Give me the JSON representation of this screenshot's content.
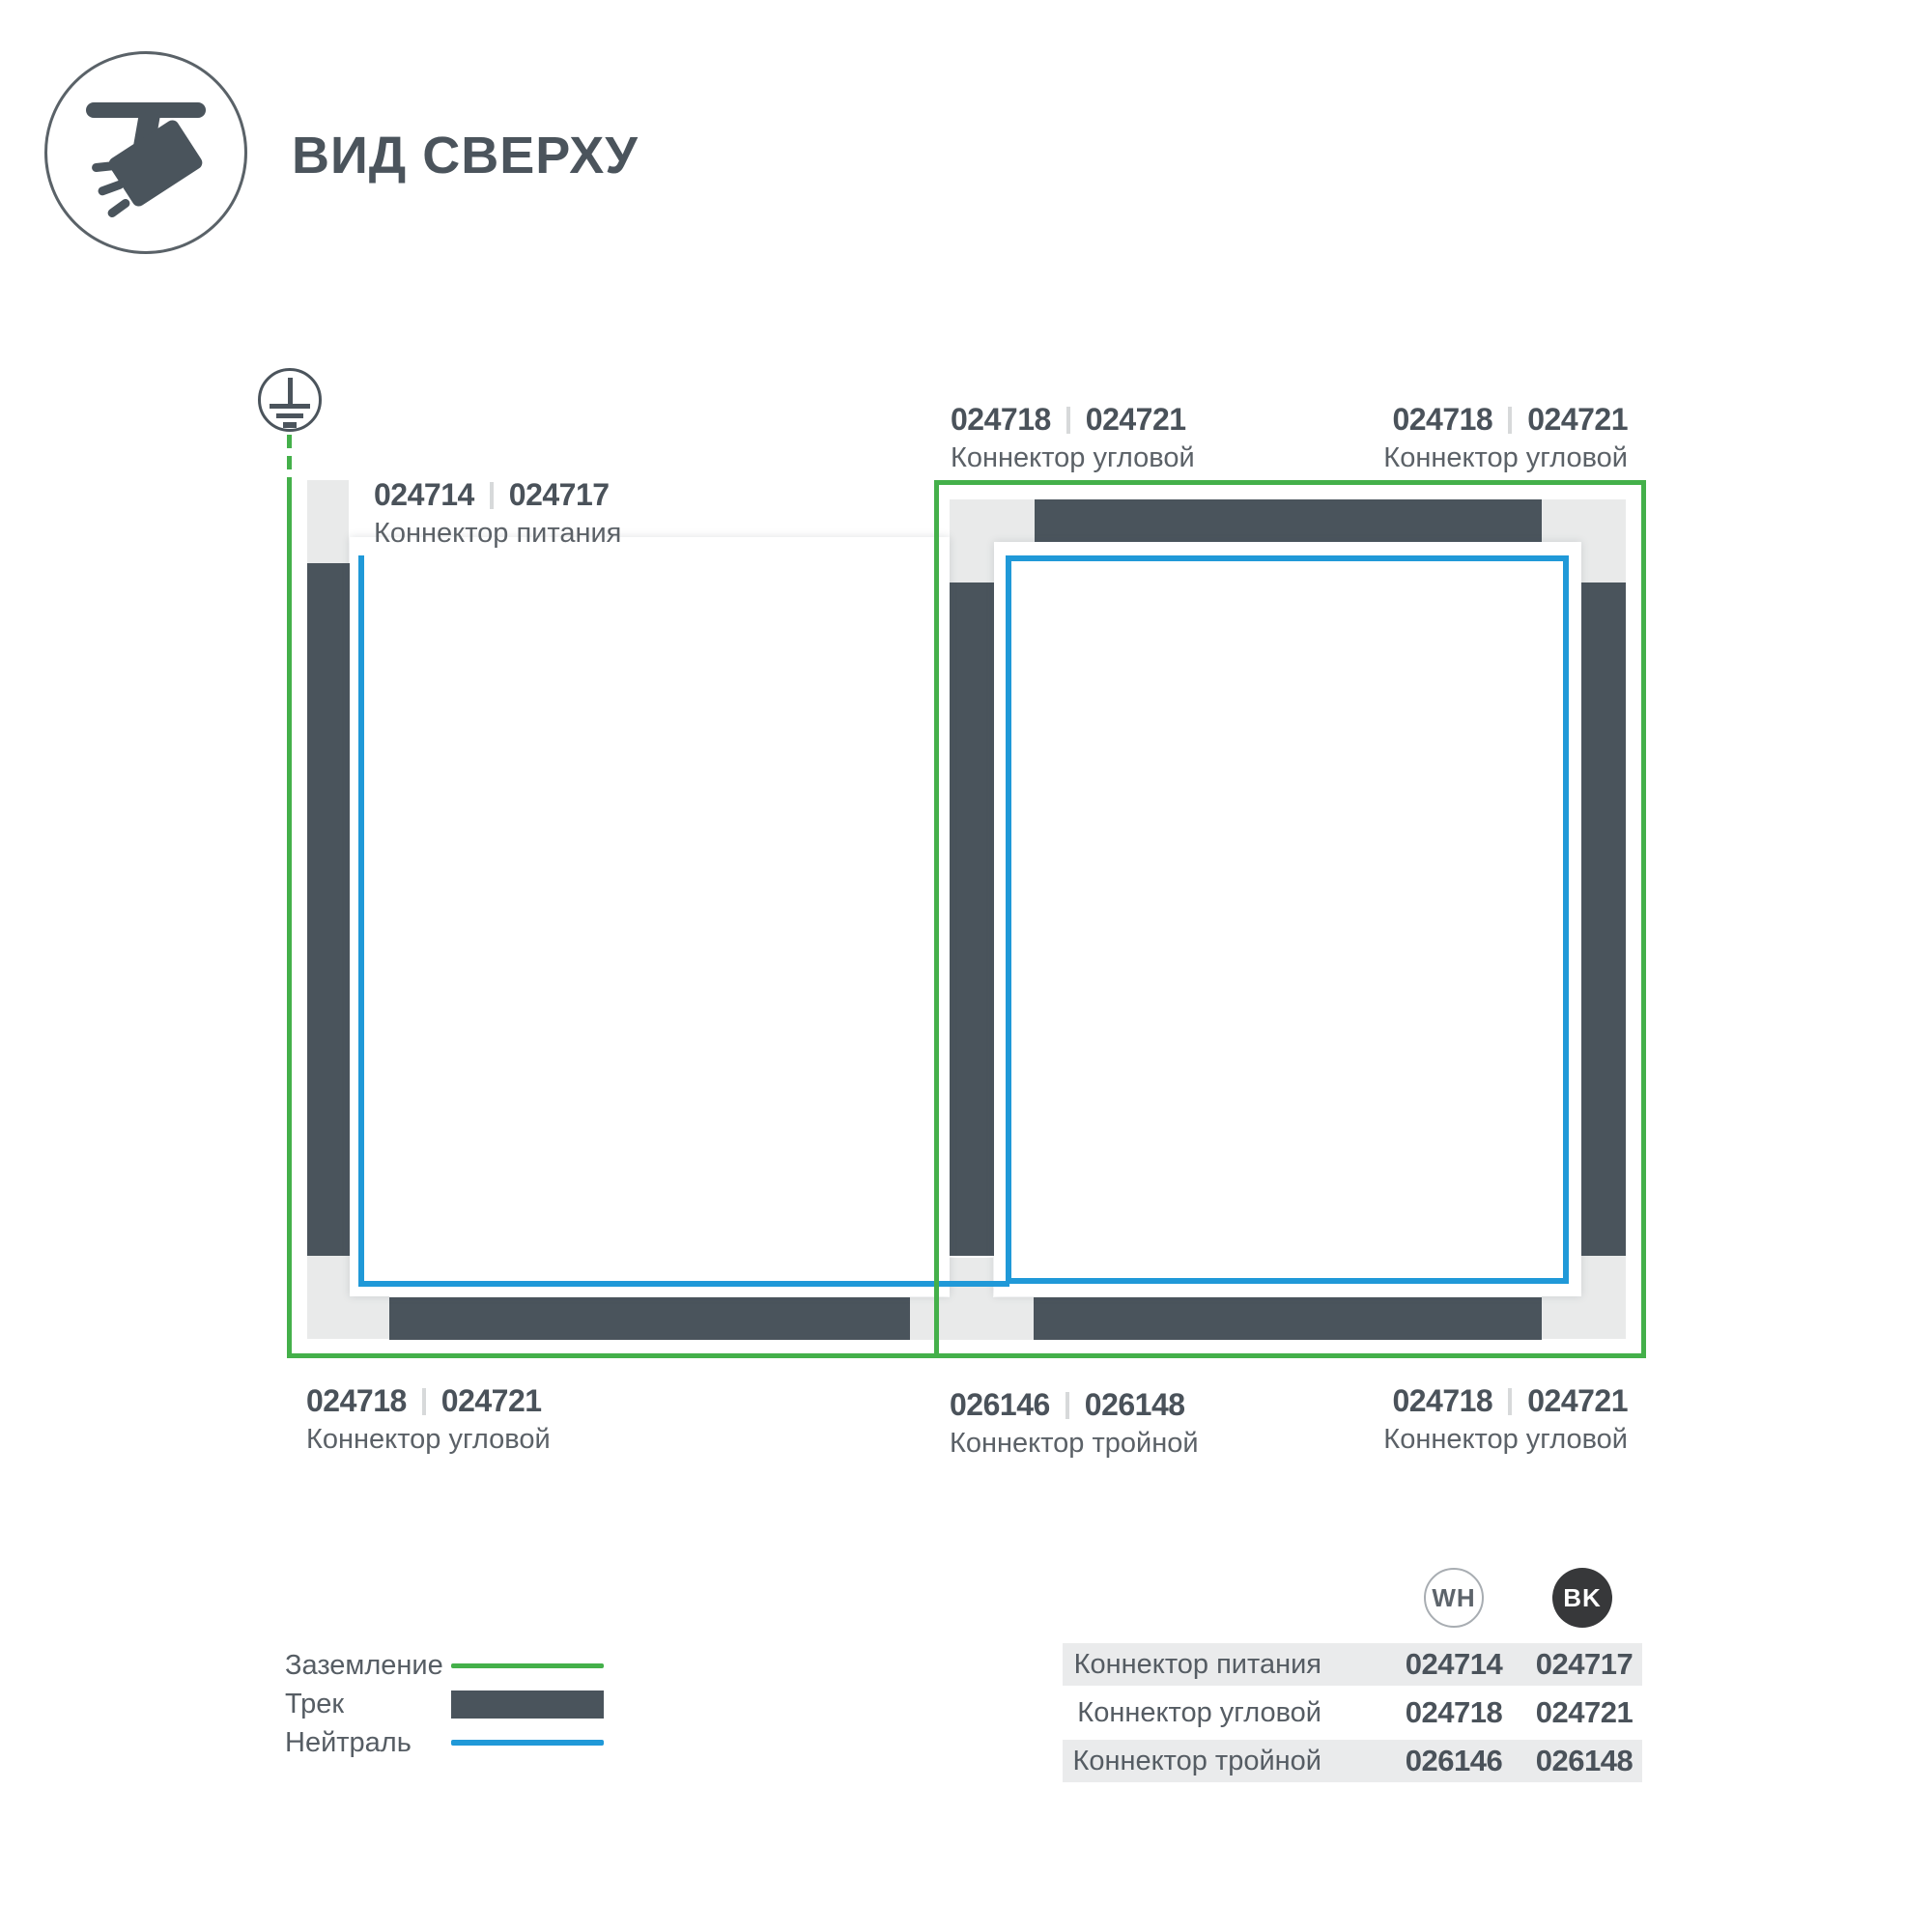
{
  "header": {
    "title": "ВИД СВЕРХУ"
  },
  "colors": {
    "ground_green": "#44b04a",
    "neutral_blue": "#2099d8",
    "track_dark": "#4a545c",
    "connector_gray": "#e9eaea"
  },
  "diagram": {
    "connector_labels": [
      {
        "code_wh": "024714",
        "code_bk": "024717",
        "name": "Коннектор питания"
      },
      {
        "code_wh": "024718",
        "code_bk": "024721",
        "name": "Коннектор угловой"
      },
      {
        "code_wh": "024718",
        "code_bk": "024721",
        "name": "Коннектор угловой"
      },
      {
        "code_wh": "024718",
        "code_bk": "024721",
        "name": "Коннектор угловой"
      },
      {
        "code_wh": "026146",
        "code_bk": "026148",
        "name": "Коннектор тройной"
      },
      {
        "code_wh": "024718",
        "code_bk": "024721",
        "name": "Коннектор угловой"
      }
    ]
  },
  "legend": {
    "items": [
      {
        "label": "Заземление"
      },
      {
        "label": "Трек"
      },
      {
        "label": "Нейтраль"
      }
    ]
  },
  "table": {
    "columns": [
      {
        "code": "WH"
      },
      {
        "code": "BK"
      }
    ],
    "rows": [
      {
        "name": "Коннектор питания",
        "wh": "024714",
        "bk": "024717"
      },
      {
        "name": "Коннектор угловой",
        "wh": "024718",
        "bk": "024721"
      },
      {
        "name": "Коннектор тройной",
        "wh": "026146",
        "bk": "026148"
      }
    ]
  }
}
